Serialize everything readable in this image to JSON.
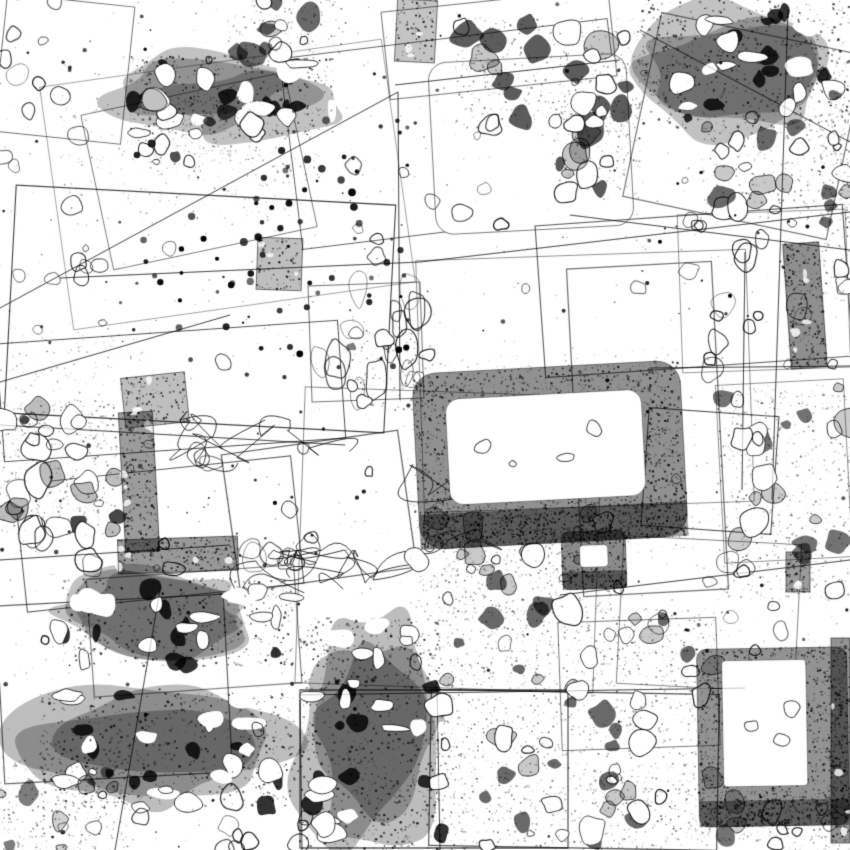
{
  "artwork": {
    "kind": "abstract-ink-collage",
    "width": 850,
    "height": 850,
    "background": "#ffffff",
    "ink": "#000000",
    "seed": 7
  },
  "tiles": [
    {
      "x": 55,
      "y": 62,
      "w": 345,
      "h": 245,
      "rot": -8
    },
    {
      "x": 10,
      "y": 195,
      "w": 380,
      "h": 228,
      "rot": 3
    },
    {
      "x": 290,
      "y": 38,
      "w": 330,
      "h": 192,
      "rot": -7
    },
    {
      "x": 432,
      "y": 58,
      "w": 198,
      "h": 172,
      "rot": -3,
      "rounded": 18,
      "fill": "#ffffff"
    },
    {
      "x": 540,
      "y": 215,
      "w": 308,
      "h": 152,
      "rot": -4
    },
    {
      "x": 420,
      "y": 255,
      "w": 330,
      "h": 252,
      "rot": -2
    },
    {
      "x": 0,
      "y": 332,
      "w": 342,
      "h": 118,
      "rot": -4
    },
    {
      "x": 95,
      "y": 92,
      "w": 208,
      "h": 158,
      "rot": -12
    },
    {
      "x": 310,
      "y": 284,
      "w": 112,
      "h": 116,
      "rot": -2
    },
    {
      "x": 575,
      "y": 265,
      "w": 145,
      "h": 328,
      "rot": -3
    },
    {
      "x": 640,
      "y": 32,
      "w": 208,
      "h": 188,
      "rot": 12
    },
    {
      "x": 680,
      "y": 212,
      "w": 168,
      "h": 158,
      "rot": -2
    },
    {
      "x": 300,
      "y": 392,
      "w": 298,
      "h": 296,
      "rot": 2
    },
    {
      "x": 0,
      "y": 600,
      "w": 228,
      "h": 178,
      "rot": -3
    },
    {
      "x": 90,
      "y": 572,
      "w": 208,
      "h": 118,
      "rot": -4
    },
    {
      "x": 20,
      "y": 470,
      "w": 278,
      "h": 128,
      "rot": -6
    },
    {
      "x": 300,
      "y": 690,
      "w": 268,
      "h": 158,
      "rot": 0
    },
    {
      "x": 430,
      "y": 692,
      "w": 288,
      "h": 156,
      "rot": 1
    },
    {
      "x": 560,
      "y": 620,
      "w": 158,
      "h": 128,
      "rot": -2
    },
    {
      "x": 620,
      "y": 540,
      "w": 178,
      "h": 148,
      "rot": 3
    },
    {
      "x": 720,
      "y": 382,
      "w": 128,
      "h": 178,
      "rot": -3
    },
    {
      "x": 385,
      "y": 0,
      "w": 228,
      "h": 88,
      "rot": -6
    },
    {
      "x": 0,
      "y": 0,
      "w": 128,
      "h": 138,
      "rot": 6
    },
    {
      "x": 230,
      "y": 442,
      "w": 178,
      "h": 138,
      "rot": -8
    },
    {
      "x": 645,
      "y": 412,
      "w": 130,
      "h": 118,
      "rot": 4
    }
  ],
  "lines": [
    [
      0,
      308,
      398,
      92
    ],
    [
      398,
      92,
      400,
      400
    ],
    [
      60,
      278,
      420,
      262
    ],
    [
      420,
      262,
      850,
      212
    ],
    [
      650,
      368,
      850,
      366
    ],
    [
      745,
      252,
      742,
      490
    ],
    [
      788,
      10,
      772,
      500
    ],
    [
      300,
      695,
      745,
      688
    ],
    [
      437,
      690,
      440,
      850
    ],
    [
      300,
      700,
      302,
      850
    ],
    [
      0,
      425,
      345,
      445
    ],
    [
      230,
      315,
      0,
      382
    ],
    [
      640,
      30,
      850,
      142
    ],
    [
      570,
      215,
      850,
      250
    ],
    [
      160,
      590,
      115,
      850
    ],
    [
      560,
      595,
      850,
      560
    ],
    [
      395,
      85,
      620,
      60
    ],
    [
      0,
      560,
      230,
      545
    ]
  ],
  "fields": [
    {
      "type": "stipple",
      "x": 60,
      "y": 95,
      "w": 260,
      "h": 130,
      "density": 0.22
    },
    {
      "type": "darkmass",
      "x": 130,
      "y": 55,
      "w": 205,
      "h": 80,
      "holes": 12,
      "dark": 0.8
    },
    {
      "type": "rubble",
      "x": 228,
      "y": 0,
      "w": 115,
      "h": 62,
      "density": 0.35,
      "blobs": 10,
      "bmin": 5,
      "bmax": 14,
      "dark": 0.7
    },
    {
      "type": "rings",
      "x": 0,
      "y": 0,
      "w": 120,
      "h": 135,
      "blobs": 8,
      "bmin": 4,
      "bmax": 13
    },
    {
      "type": "rubble",
      "x": 145,
      "y": 95,
      "w": 115,
      "h": 70,
      "density": 0.5,
      "blobs": 12,
      "bmin": 5,
      "bmax": 14,
      "dark": 0.8
    },
    {
      "type": "rubble",
      "x": 455,
      "y": 18,
      "w": 190,
      "h": 110,
      "density": 0.45,
      "blobs": 22,
      "bmin": 6,
      "bmax": 17,
      "dark": 0.75
    },
    {
      "type": "rubble",
      "x": 552,
      "y": 100,
      "w": 88,
      "h": 95,
      "density": 0.5,
      "blobs": 14,
      "bmin": 5,
      "bmax": 14,
      "dark": 0.75
    },
    {
      "type": "darkmass",
      "x": 642,
      "y": 0,
      "w": 208,
      "h": 128,
      "holes": 14,
      "dark": 0.8
    },
    {
      "type": "rubble",
      "x": 700,
      "y": 125,
      "w": 150,
      "h": 95,
      "density": 0.45,
      "blobs": 16,
      "bmin": 5,
      "bmax": 15,
      "dark": 0.7
    },
    {
      "type": "rings",
      "x": 655,
      "y": 215,
      "w": 150,
      "h": 160,
      "blobs": 16,
      "bmin": 4,
      "bmax": 13
    },
    {
      "type": "rubble",
      "x": 820,
      "y": 55,
      "w": 30,
      "h": 250,
      "density": 0.5,
      "blobs": 10,
      "bmin": 4,
      "bmax": 10,
      "dark": 0.7
    },
    {
      "type": "rings",
      "x": 0,
      "y": 140,
      "w": 130,
      "h": 190,
      "blobs": 12,
      "bmin": 3,
      "bmax": 11
    },
    {
      "type": "dots",
      "x": 130,
      "y": 120,
      "w": 290,
      "h": 260,
      "n": 80,
      "rmin": 1,
      "rmax": 4
    },
    {
      "type": "stipple",
      "x": 0,
      "y": 332,
      "w": 150,
      "h": 62,
      "density": 0.3
    },
    {
      "type": "rubble",
      "x": 0,
      "y": 400,
      "w": 118,
      "h": 135,
      "density": 0.65,
      "blobs": 26,
      "bmin": 5,
      "bmax": 15,
      "dark": 0.85
    },
    {
      "type": "rings",
      "x": 315,
      "y": 288,
      "w": 105,
      "h": 110,
      "blobs": 15,
      "bmin": 5,
      "bmax": 14,
      "elong": 1.9
    },
    {
      "type": "rings",
      "x": 20,
      "y": 430,
      "w": 300,
      "h": 145,
      "blobs": 22,
      "bmin": 4,
      "bmax": 13
    },
    {
      "type": "squiggle",
      "x": 180,
      "y": 420,
      "w": 300,
      "h": 160,
      "n": 4
    },
    {
      "type": "squiggle",
      "x": 240,
      "y": 550,
      "w": 220,
      "h": 95,
      "n": 3
    },
    {
      "type": "darkmass",
      "x": 58,
      "y": 578,
      "w": 235,
      "h": 88,
      "holes": 16,
      "dark": 0.8
    },
    {
      "type": "darkmass",
      "x": 40,
      "y": 693,
      "w": 255,
      "h": 115,
      "holes": 18,
      "dark": 0.85
    },
    {
      "type": "darkmass",
      "x": 298,
      "y": 618,
      "w": 145,
      "h": 232,
      "holes": 20,
      "dark": 0.85
    },
    {
      "type": "rubble",
      "x": 415,
      "y": 498,
      "w": 200,
      "h": 115,
      "density": 0.6,
      "blobs": 18,
      "bmin": 5,
      "bmax": 14,
      "dark": 0.7
    },
    {
      "type": "rubble",
      "x": 432,
      "y": 608,
      "w": 290,
      "h": 150,
      "density": 0.5,
      "blobs": 28,
      "bmin": 5,
      "bmax": 16,
      "dark": 0.7
    },
    {
      "type": "rubble",
      "x": 432,
      "y": 762,
      "w": 290,
      "h": 88,
      "density": 0.5,
      "blobs": 20,
      "bmin": 5,
      "bmax": 14,
      "dark": 0.7
    },
    {
      "type": "rubble",
      "x": 718,
      "y": 385,
      "w": 132,
      "h": 215,
      "density": 0.42,
      "blobs": 22,
      "bmin": 5,
      "bmax": 14,
      "dark": 0.65
    },
    {
      "type": "rubble",
      "x": 0,
      "y": 755,
      "w": 130,
      "h": 95,
      "density": 0.4,
      "blobs": 12,
      "bmin": 4,
      "bmax": 12,
      "dark": 0.6
    },
    {
      "type": "rings",
      "x": 120,
      "y": 790,
      "w": 190,
      "h": 60,
      "blobs": 10,
      "bmin": 4,
      "bmax": 11
    },
    {
      "type": "rubble",
      "x": 715,
      "y": 790,
      "w": 135,
      "h": 60,
      "density": 0.45,
      "blobs": 10,
      "bmin": 4,
      "bmax": 12,
      "dark": 0.65
    },
    {
      "type": "rings",
      "x": 330,
      "y": 120,
      "w": 180,
      "h": 140,
      "blobs": 10,
      "bmin": 4,
      "bmax": 12
    },
    {
      "type": "rubble",
      "x": 345,
      "y": 330,
      "w": 90,
      "h": 80,
      "density": 0.4,
      "blobs": 8,
      "bmin": 4,
      "bmax": 12,
      "dark": 0.6
    },
    {
      "type": "rings",
      "x": 600,
      "y": 560,
      "w": 190,
      "h": 85,
      "blobs": 9,
      "bmin": 4,
      "bmax": 11
    },
    {
      "type": "rings",
      "x": 0,
      "y": 0,
      "w": 850,
      "h": 850,
      "blobs": 40,
      "bmin": 3,
      "bmax": 9
    },
    {
      "type": "dots",
      "x": 0,
      "y": 0,
      "w": 850,
      "h": 850,
      "n": 160,
      "rmin": 0.6,
      "rmax": 2.4
    },
    {
      "type": "stipple",
      "x": 0,
      "y": 0,
      "w": 850,
      "h": 850,
      "density": 0.035
    }
  ],
  "features": [
    {
      "type": "ring",
      "cx": 550,
      "cy": 455,
      "ow": 268,
      "oh": 176,
      "iw": 196,
      "ih": 106,
      "ix": -4,
      "iy": -8,
      "rot": -3,
      "r": 24,
      "dark": 0.82,
      "innerRings": 4
    },
    {
      "type": "ring",
      "cx": 594,
      "cy": 560,
      "ow": 64,
      "oh": 58,
      "iw": 28,
      "ih": 22,
      "ix": 0,
      "iy": -4,
      "rot": -2,
      "r": 7,
      "dark": 0.85,
      "innerRings": 0
    },
    {
      "type": "ring",
      "cx": 773,
      "cy": 737,
      "ow": 150,
      "oh": 178,
      "iw": 84,
      "ih": 126,
      "ix": -8,
      "iy": -14,
      "rot": -1,
      "r": 10,
      "dark": 0.8,
      "innerRings": 3
    },
    {
      "type": "bar",
      "x": 787,
      "y": 243,
      "w": 36,
      "h": 125,
      "rot": -4,
      "dark": 0.88
    },
    {
      "type": "bar",
      "x": 831,
      "y": 638,
      "w": 19,
      "h": 205,
      "rot": 0,
      "dark": 0.85
    },
    {
      "type": "bar",
      "x": 122,
      "y": 412,
      "w": 34,
      "h": 140,
      "rot": -3,
      "dark": 0.78
    },
    {
      "type": "bar",
      "x": 118,
      "y": 538,
      "w": 120,
      "h": 34,
      "rot": -2,
      "dark": 0.8
    },
    {
      "type": "bar",
      "x": 123,
      "y": 375,
      "w": 64,
      "h": 50,
      "rot": -6,
      "dark": 0.5
    },
    {
      "type": "bar",
      "x": 257,
      "y": 238,
      "w": 45,
      "h": 52,
      "rot": 2,
      "dark": 0.5
    },
    {
      "type": "bar",
      "x": 786,
      "y": 552,
      "w": 24,
      "h": 40,
      "rot": 0,
      "dark": 0.78
    },
    {
      "type": "bar",
      "x": 396,
      "y": 0,
      "w": 40,
      "h": 62,
      "rot": 3,
      "dark": 0.45
    }
  ]
}
